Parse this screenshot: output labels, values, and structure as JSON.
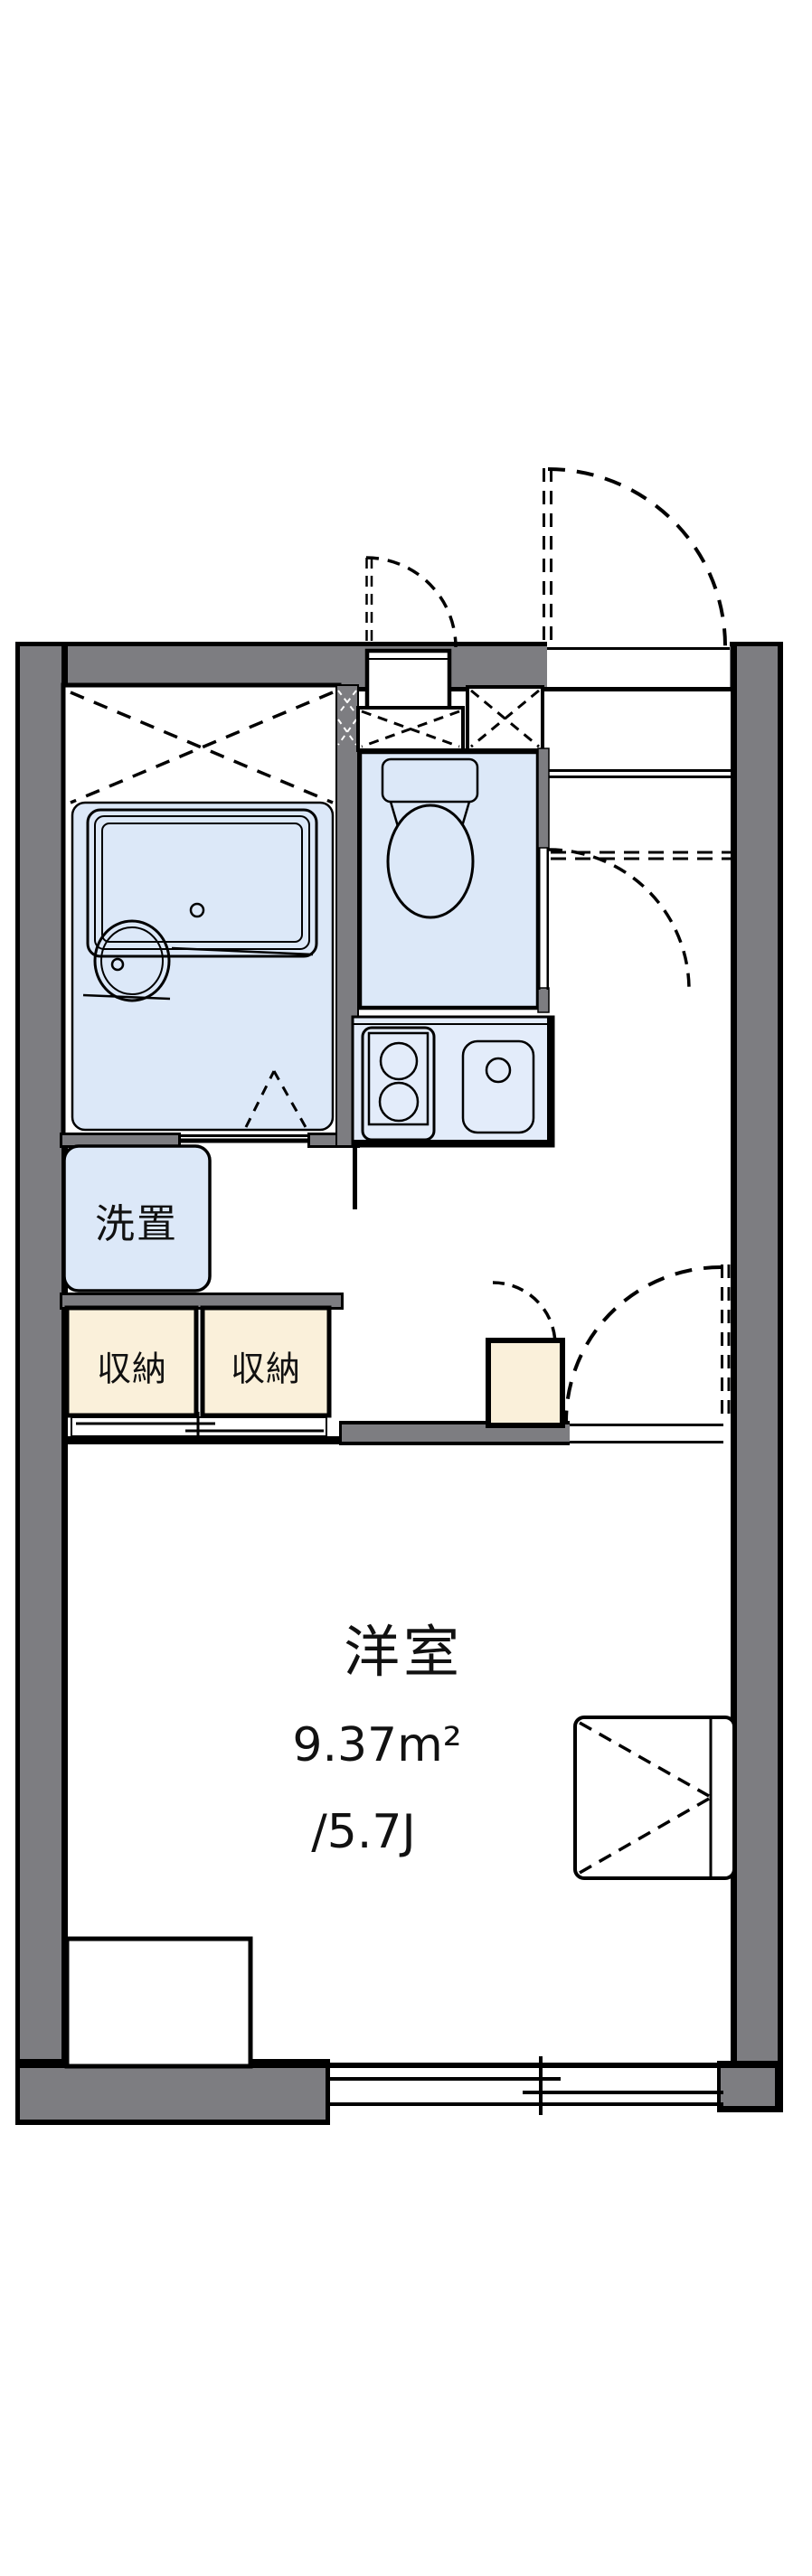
{
  "rooms": {
    "main_room": {
      "label": "洋室",
      "area_m2": "9.37m²",
      "area_tatami": "/5.7J"
    },
    "washer_space": {
      "label": "洗置"
    },
    "closets": [
      {
        "label": "収納"
      },
      {
        "label": "収納"
      }
    ]
  },
  "fixtures": [
    "bathtub",
    "washbasin",
    "toilet",
    "kitchen-stove",
    "kitchen-sink",
    "entrance-door",
    "meter-box-door",
    "toilet-door",
    "room-door",
    "closet-sliding-doors",
    "sliding-window",
    "fold-out-unit",
    "desk-counter"
  ],
  "colors": {
    "wall_gray": "#7d7d81",
    "wet_area_blue": "#dce8f8",
    "kitchen_blue": "#e3ecfa",
    "closet_cream": "#faf0da",
    "outline": "#000000",
    "background": "#ffffff"
  }
}
